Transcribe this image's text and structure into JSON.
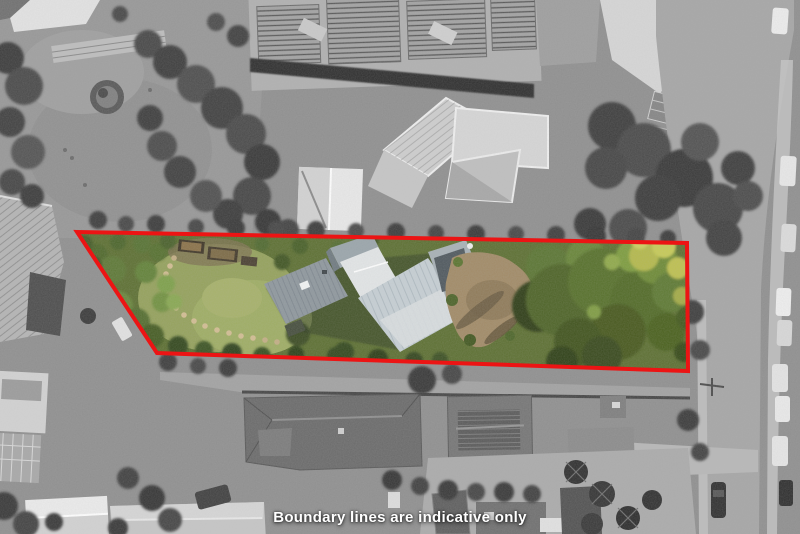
{
  "overlay": {
    "caption": "Boundary lines are indicative only",
    "boundary_color": "#ec1414",
    "boundary_points": "77,232 687,243 688,371 157,353",
    "boundary_stroke_width": "4"
  }
}
